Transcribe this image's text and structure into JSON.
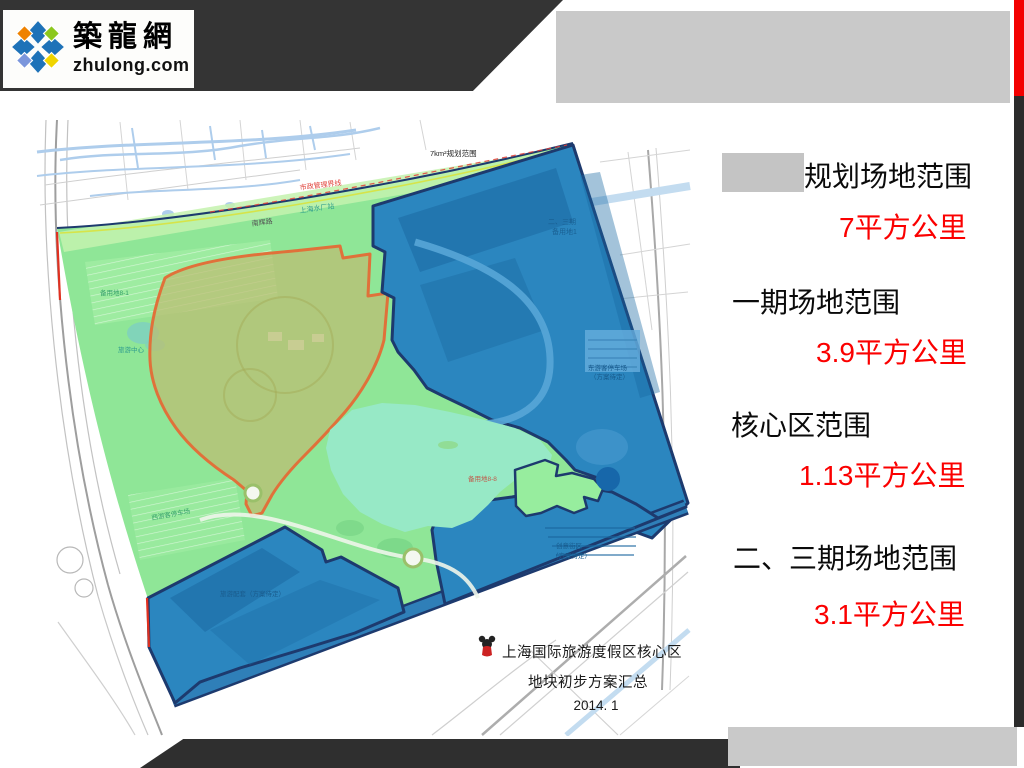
{
  "brand": {
    "cn": "築龍網",
    "en": "zhulong.com"
  },
  "panel": {
    "rows": [
      {
        "label": "规划场地范围",
        "value": "7平方公里"
      },
      {
        "label": "一期场地范围",
        "value": "3.9平方公里"
      },
      {
        "label": "核心区范围",
        "value": "1.13平方公里"
      },
      {
        "label": "二、三期场地范围",
        "value": "3.1平方公里"
      }
    ]
  },
  "map": {
    "caption": {
      "line1": "上海国际旅游度假区核心区",
      "line2": "地块初步方案汇总",
      "line3": "2014. 1"
    },
    "annotations": {
      "scope": "7km²规划范围",
      "boundary_red": "市政管理界线",
      "road_top": "南辉路",
      "station_top": "上海水厂站",
      "ne_label1": "二、三期",
      "ne_label2": "备用地1",
      "ne_parking1": "东游客停车场",
      "ne_parking2": "（方案待定）",
      "se_label1": "创意街区",
      "se_label2": "（方案待定）",
      "sw_label1": "旅游配套（方案待定）",
      "green_label1": "备用地8-1",
      "green_label2": "旅游中心",
      "green_label3": "西游客停车场",
      "lake_label": "备用地8-8"
    }
  },
  "colors": {
    "accent_red": "#f30000",
    "red_text": "#fb0000",
    "panel_gray": "#c9c9c9",
    "header_dark": "#343434",
    "site_green": "#8fe697",
    "site_blue": "#2b86bf",
    "navy_border": "#1d3a6e",
    "lake_aqua": "#97e9c6",
    "core_orange": "#e0713a"
  }
}
